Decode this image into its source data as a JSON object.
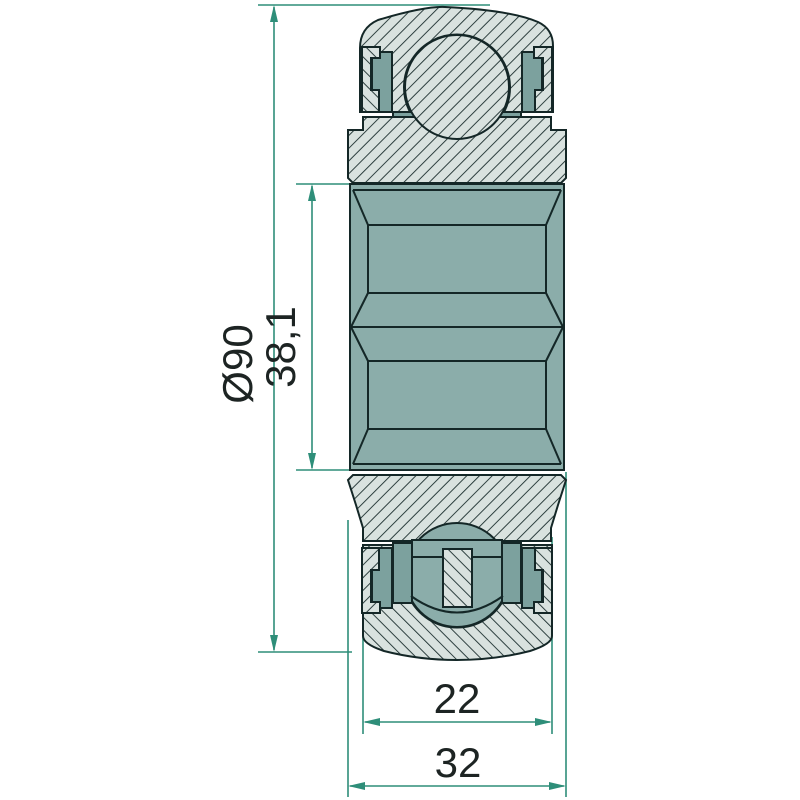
{
  "drawing": {
    "type": "bearing-cross-section-technical-drawing",
    "dimensions": {
      "outer_diameter": {
        "label": "Ø90"
      },
      "bore_square": {
        "label": "38,1"
      },
      "outer_ring_width": {
        "label": "22"
      },
      "total_width": {
        "label": "32"
      }
    },
    "colors": {
      "background": "#ffffff",
      "section_light": "#d9e2df",
      "solid_teal": "#8badaa",
      "dark_teal": "#7ca19e",
      "outline": "#142727",
      "hatch_line": "#1b2e2e",
      "dimension_line": "#2e8e79",
      "label_text": "#1d2423"
    }
  }
}
